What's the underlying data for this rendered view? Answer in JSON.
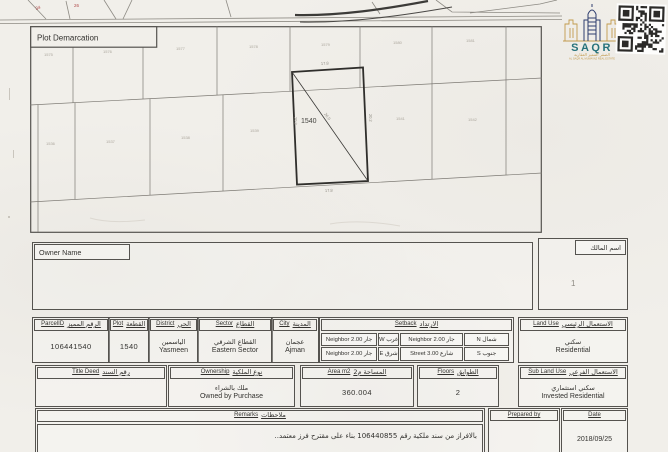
{
  "colors": {
    "paper": "#f1efea",
    "ink": "#33322f",
    "line": "#55534f",
    "faint_parcel": "#aca79e",
    "red_mark": "#b04a4a",
    "logo_teal": "#27727b",
    "logo_gold": "#c29a4d",
    "logo_navy": "#2e3d6e"
  },
  "strip": {
    "red_marks": [
      "34",
      "26"
    ]
  },
  "logo": {
    "brand": "SAQR",
    "arabic": "الصقر المميز العقارية",
    "english": "AL SAQR AL MUMAYAZ REAL ESTATE"
  },
  "qr": {
    "icon": "qr-code"
  },
  "map": {
    "title": "Plot Demarcation",
    "plot_number": "1540",
    "dims": {
      "top": "17.8",
      "bottom": "17.8",
      "left": "20.2",
      "right": "20.2",
      "diagonal": "26.9"
    },
    "top_parcels": [
      "1575",
      "1576",
      "1577",
      "1578",
      "1579",
      "1580",
      "1581"
    ],
    "mid_parcels": [
      "1536",
      "1537",
      "1538",
      "1539",
      "1541",
      "1542"
    ]
  },
  "owner": {
    "label_en": "Owner Name",
    "label_ar": "اسم المالك",
    "mark": "1"
  },
  "fields": {
    "parcel": {
      "en": "ParcelID",
      "ar": "الرقم المميز",
      "value": "106441540"
    },
    "plot": {
      "en": "Plot",
      "ar": "القطعة",
      "value": "1540"
    },
    "district": {
      "en": "District",
      "ar": "الحي",
      "value_ar": "الياسمين",
      "value_en": "Yasmeen"
    },
    "sector": {
      "en": "Sector",
      "ar": "القطاع",
      "value_ar": "القطاع الشرقي",
      "value_en": "Eastern Sector"
    },
    "city": {
      "en": "City",
      "ar": "المدينة",
      "value_ar": "عجمان",
      "value_en": "Ajman"
    },
    "setback": {
      "en": "Setback",
      "ar": "الارتداد",
      "rows": [
        [
          "جار Neighbor 2.00",
          "غرب W",
          "جار Neighbor 2.00",
          "شمال N"
        ],
        [
          "جار Neighbor 2.00",
          "شرق E",
          "شارع Street 3.00",
          "جنوب S"
        ]
      ]
    },
    "land_use": {
      "en": "Land Use",
      "ar": "الاستعمال الرئيسي",
      "value_ar": "سكني",
      "value_en": "Residential"
    },
    "title_deed": {
      "en": "Title Deed",
      "ar": "رقم السند",
      "value": ""
    },
    "ownership": {
      "en": "Ownership",
      "ar": "نوع الملكية",
      "value_ar": "ملك بالشراء",
      "value_en": "Owned by Purchase"
    },
    "area": {
      "en": "Area m2",
      "ar": "المساحة م2",
      "value": "360.004"
    },
    "floors": {
      "en": "Floors",
      "ar": "الطوابق",
      "value": "2"
    },
    "sub_land_use": {
      "en": "Sub Land Use",
      "ar": "الاستعمال الفرعي",
      "value_ar": "سكني استثماري",
      "value_en": "Invested Residential"
    },
    "remarks": {
      "en": "Remarks",
      "ar": "ملاحظات",
      "text": "بالافراز من سند ملكية رقم 106440855 بناء على مقترح فرز معتمد.."
    },
    "prepared_by": {
      "en": "Prepared by",
      "value": ""
    },
    "date": {
      "en": "Date",
      "value": "2018/09/25"
    }
  }
}
